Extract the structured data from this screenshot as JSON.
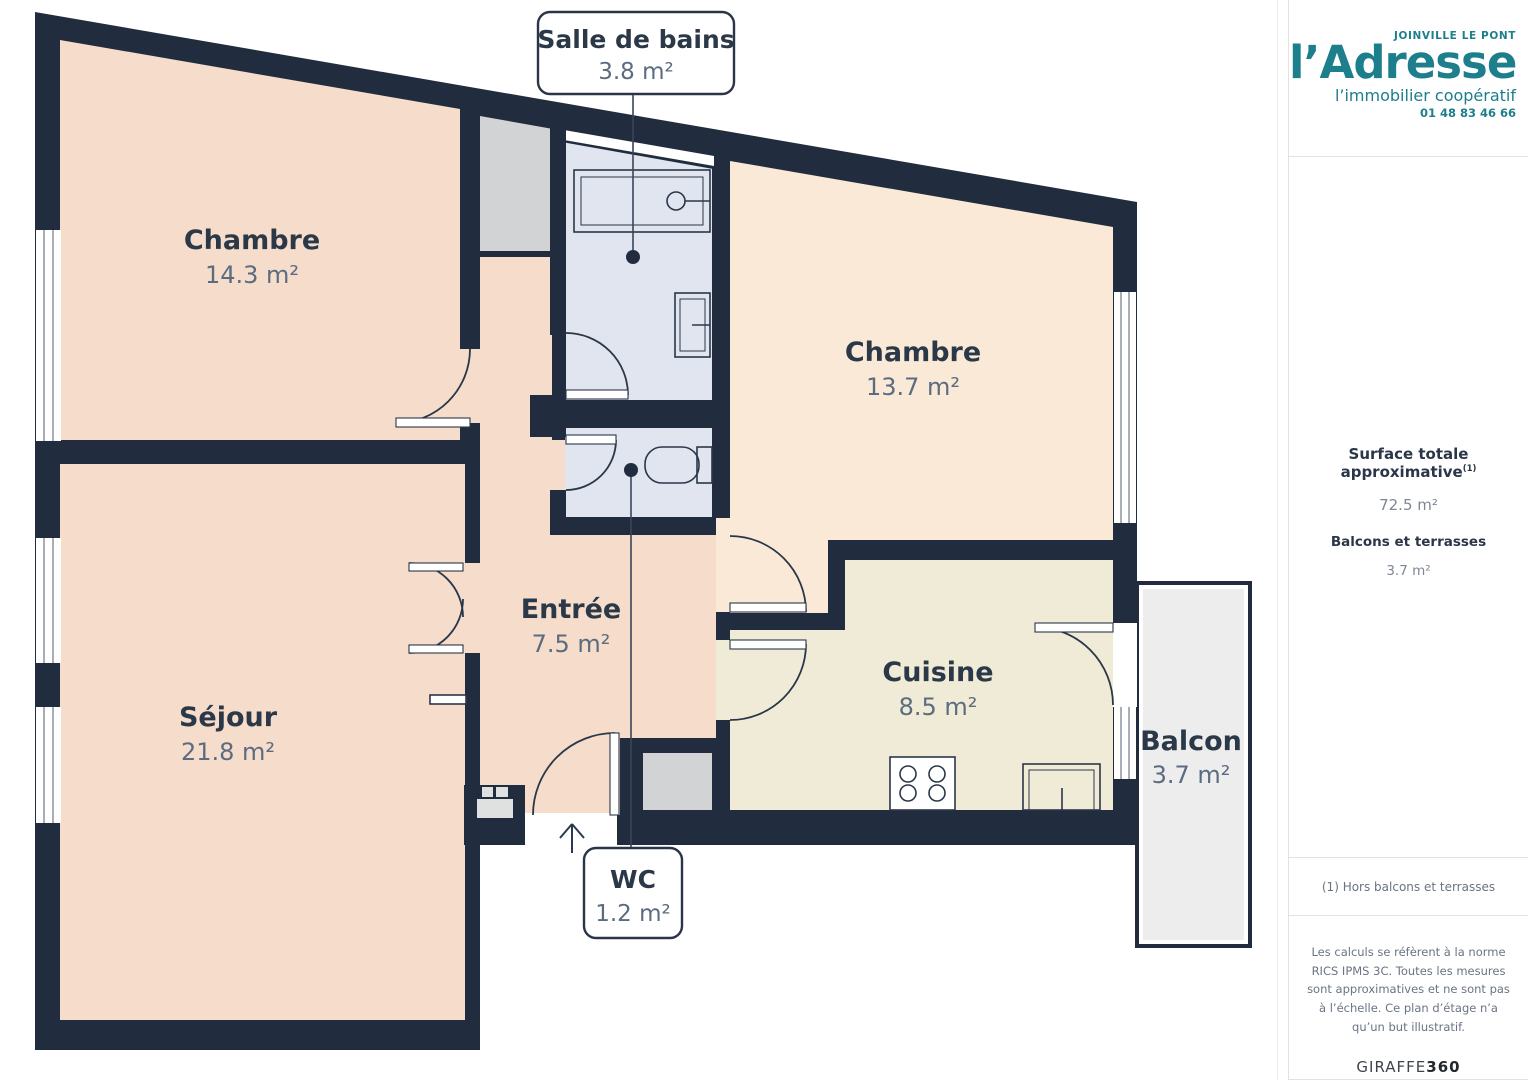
{
  "plan": {
    "rooms": [
      {
        "id": "chambre1",
        "name": "Chambre",
        "area": "14.3 m²"
      },
      {
        "id": "sejour",
        "name": "Séjour",
        "area": "21.8 m²"
      },
      {
        "id": "entree",
        "name": "Entrée",
        "area": "7.5 m²"
      },
      {
        "id": "chambre2",
        "name": "Chambre",
        "area": "13.7 m²"
      },
      {
        "id": "cuisine",
        "name": "Cuisine",
        "area": "8.5 m²"
      },
      {
        "id": "balcon",
        "name": "Balcon",
        "area": "3.7 m²"
      }
    ],
    "callouts": [
      {
        "id": "salle_de_bains",
        "name": "Salle de bains",
        "area": "3.8 m²"
      },
      {
        "id": "wc",
        "name": "WC",
        "area": "1.2 m²"
      }
    ],
    "colors": {
      "wall": "#212D3E",
      "room_salmon": "#F5DCCB",
      "room_peach": "#FBE9D7",
      "room_cream": "#F0EBD6",
      "room_wet_blue": "#E0E5F0",
      "balcony_gray": "#EDEDEE",
      "closet_gray": "#D2D3D4",
      "label_navy": "#2B3847",
      "label_gray": "#5C6C80"
    }
  },
  "sidebar": {
    "logo": {
      "city": "JOINVILLE LE PONT",
      "brand": "l’Adresse",
      "tagline": "l’immobilier coopératif",
      "phone": "01 48 83 46 66",
      "teal": "#1D7E8C"
    },
    "surface": {
      "label": "Surface totale approximative",
      "marker": "(1)",
      "value": "72.5 m²",
      "balconies_label": "Balcons et terrasses",
      "balconies_value": "3.7 m²"
    },
    "footnote": "(1) Hors balcons et terrasses",
    "legal": "Les calculs se réfèrent à la norme RICS IPMS 3C. Toutes les mesures sont approximatives et ne sont pas à l’échelle. Ce plan d’étage n’a qu’un but illustratif.",
    "brand_footer_regular": "GIRAFFE",
    "brand_footer_bold": "360"
  }
}
